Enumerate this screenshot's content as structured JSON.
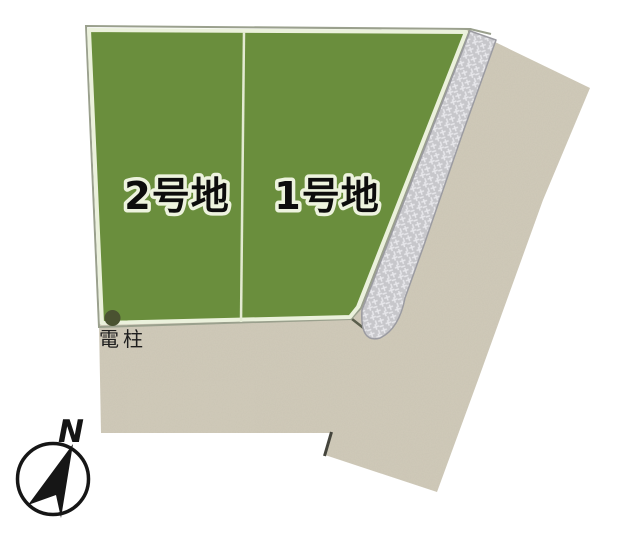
{
  "diagram": {
    "type": "land-lot-site-plan",
    "plots": [
      {
        "id": "1",
        "label": "1号地"
      },
      {
        "id": "2",
        "label": "2号地"
      }
    ],
    "annotations": {
      "utility_pole_label": "電柱"
    },
    "compass": {
      "north_label": "N"
    },
    "colors": {
      "background": "#ffffff",
      "lot_fill": "#6a8e3d",
      "lot_pale_border": "#ebf1dc",
      "lot_outer_line": "#9aa08d",
      "road_fill": "#d1cbba",
      "hatch_base": "#c7c7cb",
      "hatch_mark": "#e7e7eb",
      "hatch_border": "#9b9ba1",
      "divider_line": "#e3ead2",
      "label_text": "#0d0d0d",
      "label_outline": "#edf3de",
      "pole_dot": "#4a5231",
      "pole_text": "#1e1e1e",
      "compass_ink": "#161616",
      "shadow_line": "#44443c"
    }
  }
}
